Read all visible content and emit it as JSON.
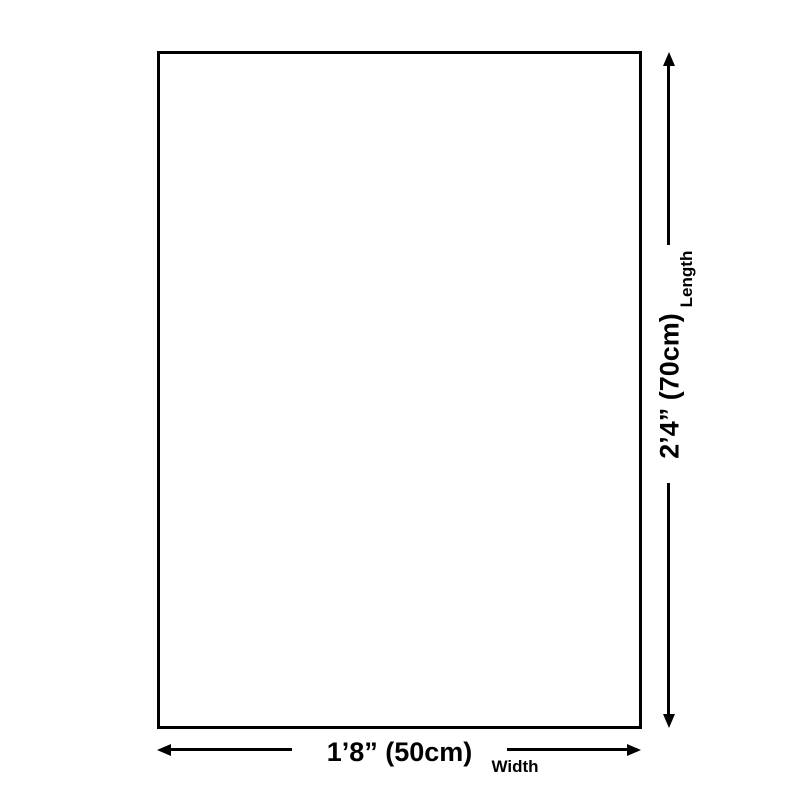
{
  "diagram": {
    "type": "product-dimension-diagram",
    "colors": {
      "background": "#ffffff",
      "line": "#000000",
      "text": "#000000"
    },
    "length": {
      "value": "2’4” (70cm)",
      "label": "Length"
    },
    "width": {
      "value": "1’8” (50cm)",
      "label": "Width"
    }
  }
}
